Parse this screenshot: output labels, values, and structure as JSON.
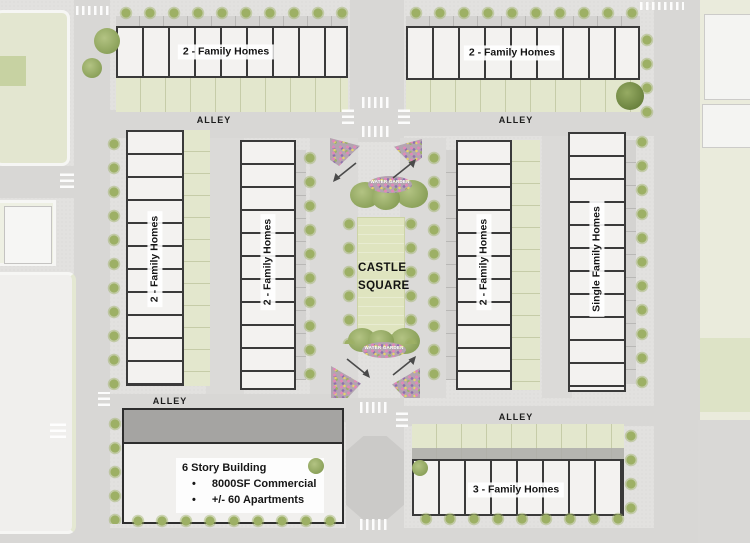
{
  "plan": {
    "square_label": "CASTLE SQUARE",
    "water_garden_top_label": "WATER GARDEN",
    "water_garden_bottom_label": "WATER GARDEN",
    "alleys": {
      "top_left": "ALLEY",
      "top_right": "ALLEY",
      "bottom_left": "ALLEY",
      "bottom_right": "ALLEY"
    },
    "blocks": {
      "top_left": "2 - Family Homes",
      "top_right": "2 - Family Homes",
      "west": "2 - Family Homes",
      "center_west": "2 - Family Homes",
      "center_east": "2 - Family Homes",
      "east": "Single Family Homes",
      "bottom_right": "3 - Family Homes"
    },
    "building": {
      "title": "6 Story Building",
      "bullet_glyph": "•",
      "bullets": [
        "8000SF Commercial",
        "+/- 60 Apartments"
      ]
    }
  },
  "colors": {
    "tree_green": "#9db065",
    "yard_green": "#e3e7cd",
    "lawn_green": "#dfe4bf",
    "street_gray": "#d8d7d5",
    "unit_outline": "#3a3a3a",
    "flower_bed": "#b3a4b0"
  }
}
